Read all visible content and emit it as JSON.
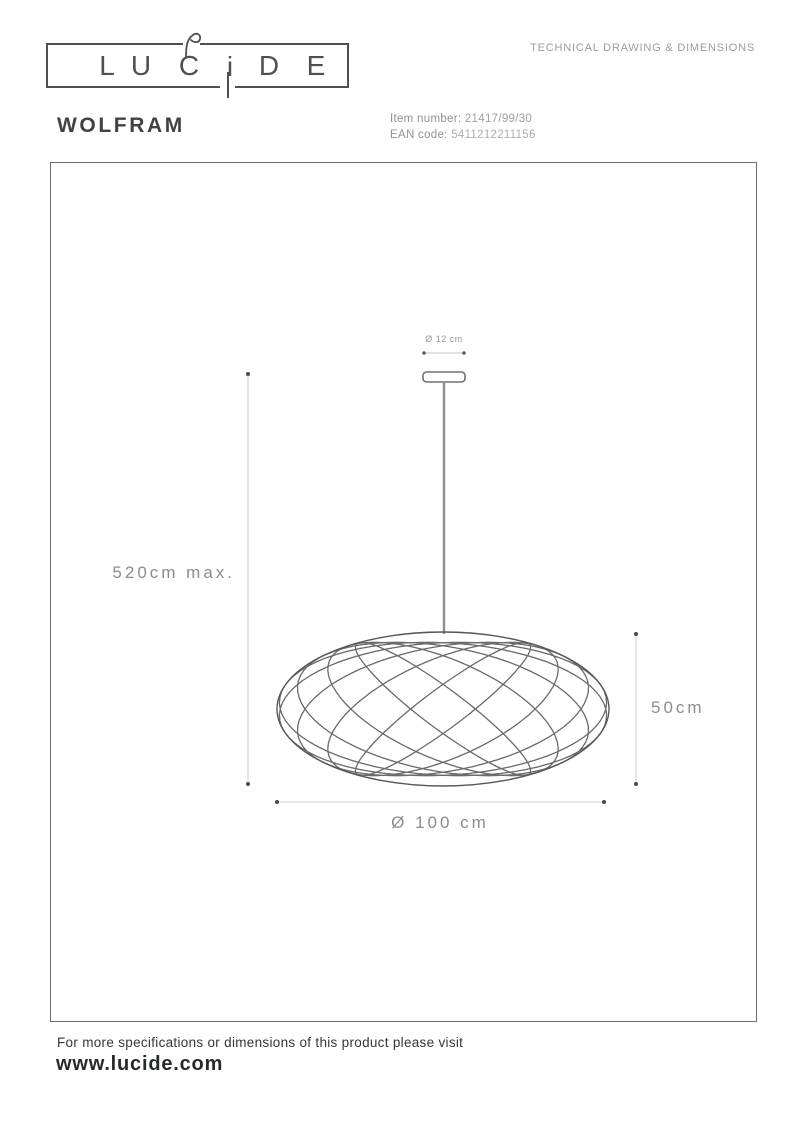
{
  "brand": {
    "letters": [
      "L",
      "U",
      "C",
      "i",
      "D",
      "E"
    ]
  },
  "header": {
    "doc_title": "TECHNICAL DRAWING & DIMENSIONS"
  },
  "product": {
    "name": "WOLFRAM",
    "item_number_label": "Item number:",
    "item_number": "21417/99/30",
    "ean_label": "EAN code:",
    "ean": "5411212211156"
  },
  "drawing": {
    "canopy_diameter_label": "Ø 12 cm",
    "drop_height_label": "520cm max.",
    "shade_height_label": "50cm",
    "shade_diameter_label": "Ø 100 cm"
  },
  "footer": {
    "note": "For more specifications or dimensions of this product please visit",
    "website": "www.lucide.com"
  },
  "colors": {
    "ink": "#3f4348",
    "muted_text": "#989ea6",
    "dimension_text": "#8c8c8c",
    "drawing_line": "#6b6b6b",
    "dimension_line": "#c6c6c6"
  }
}
